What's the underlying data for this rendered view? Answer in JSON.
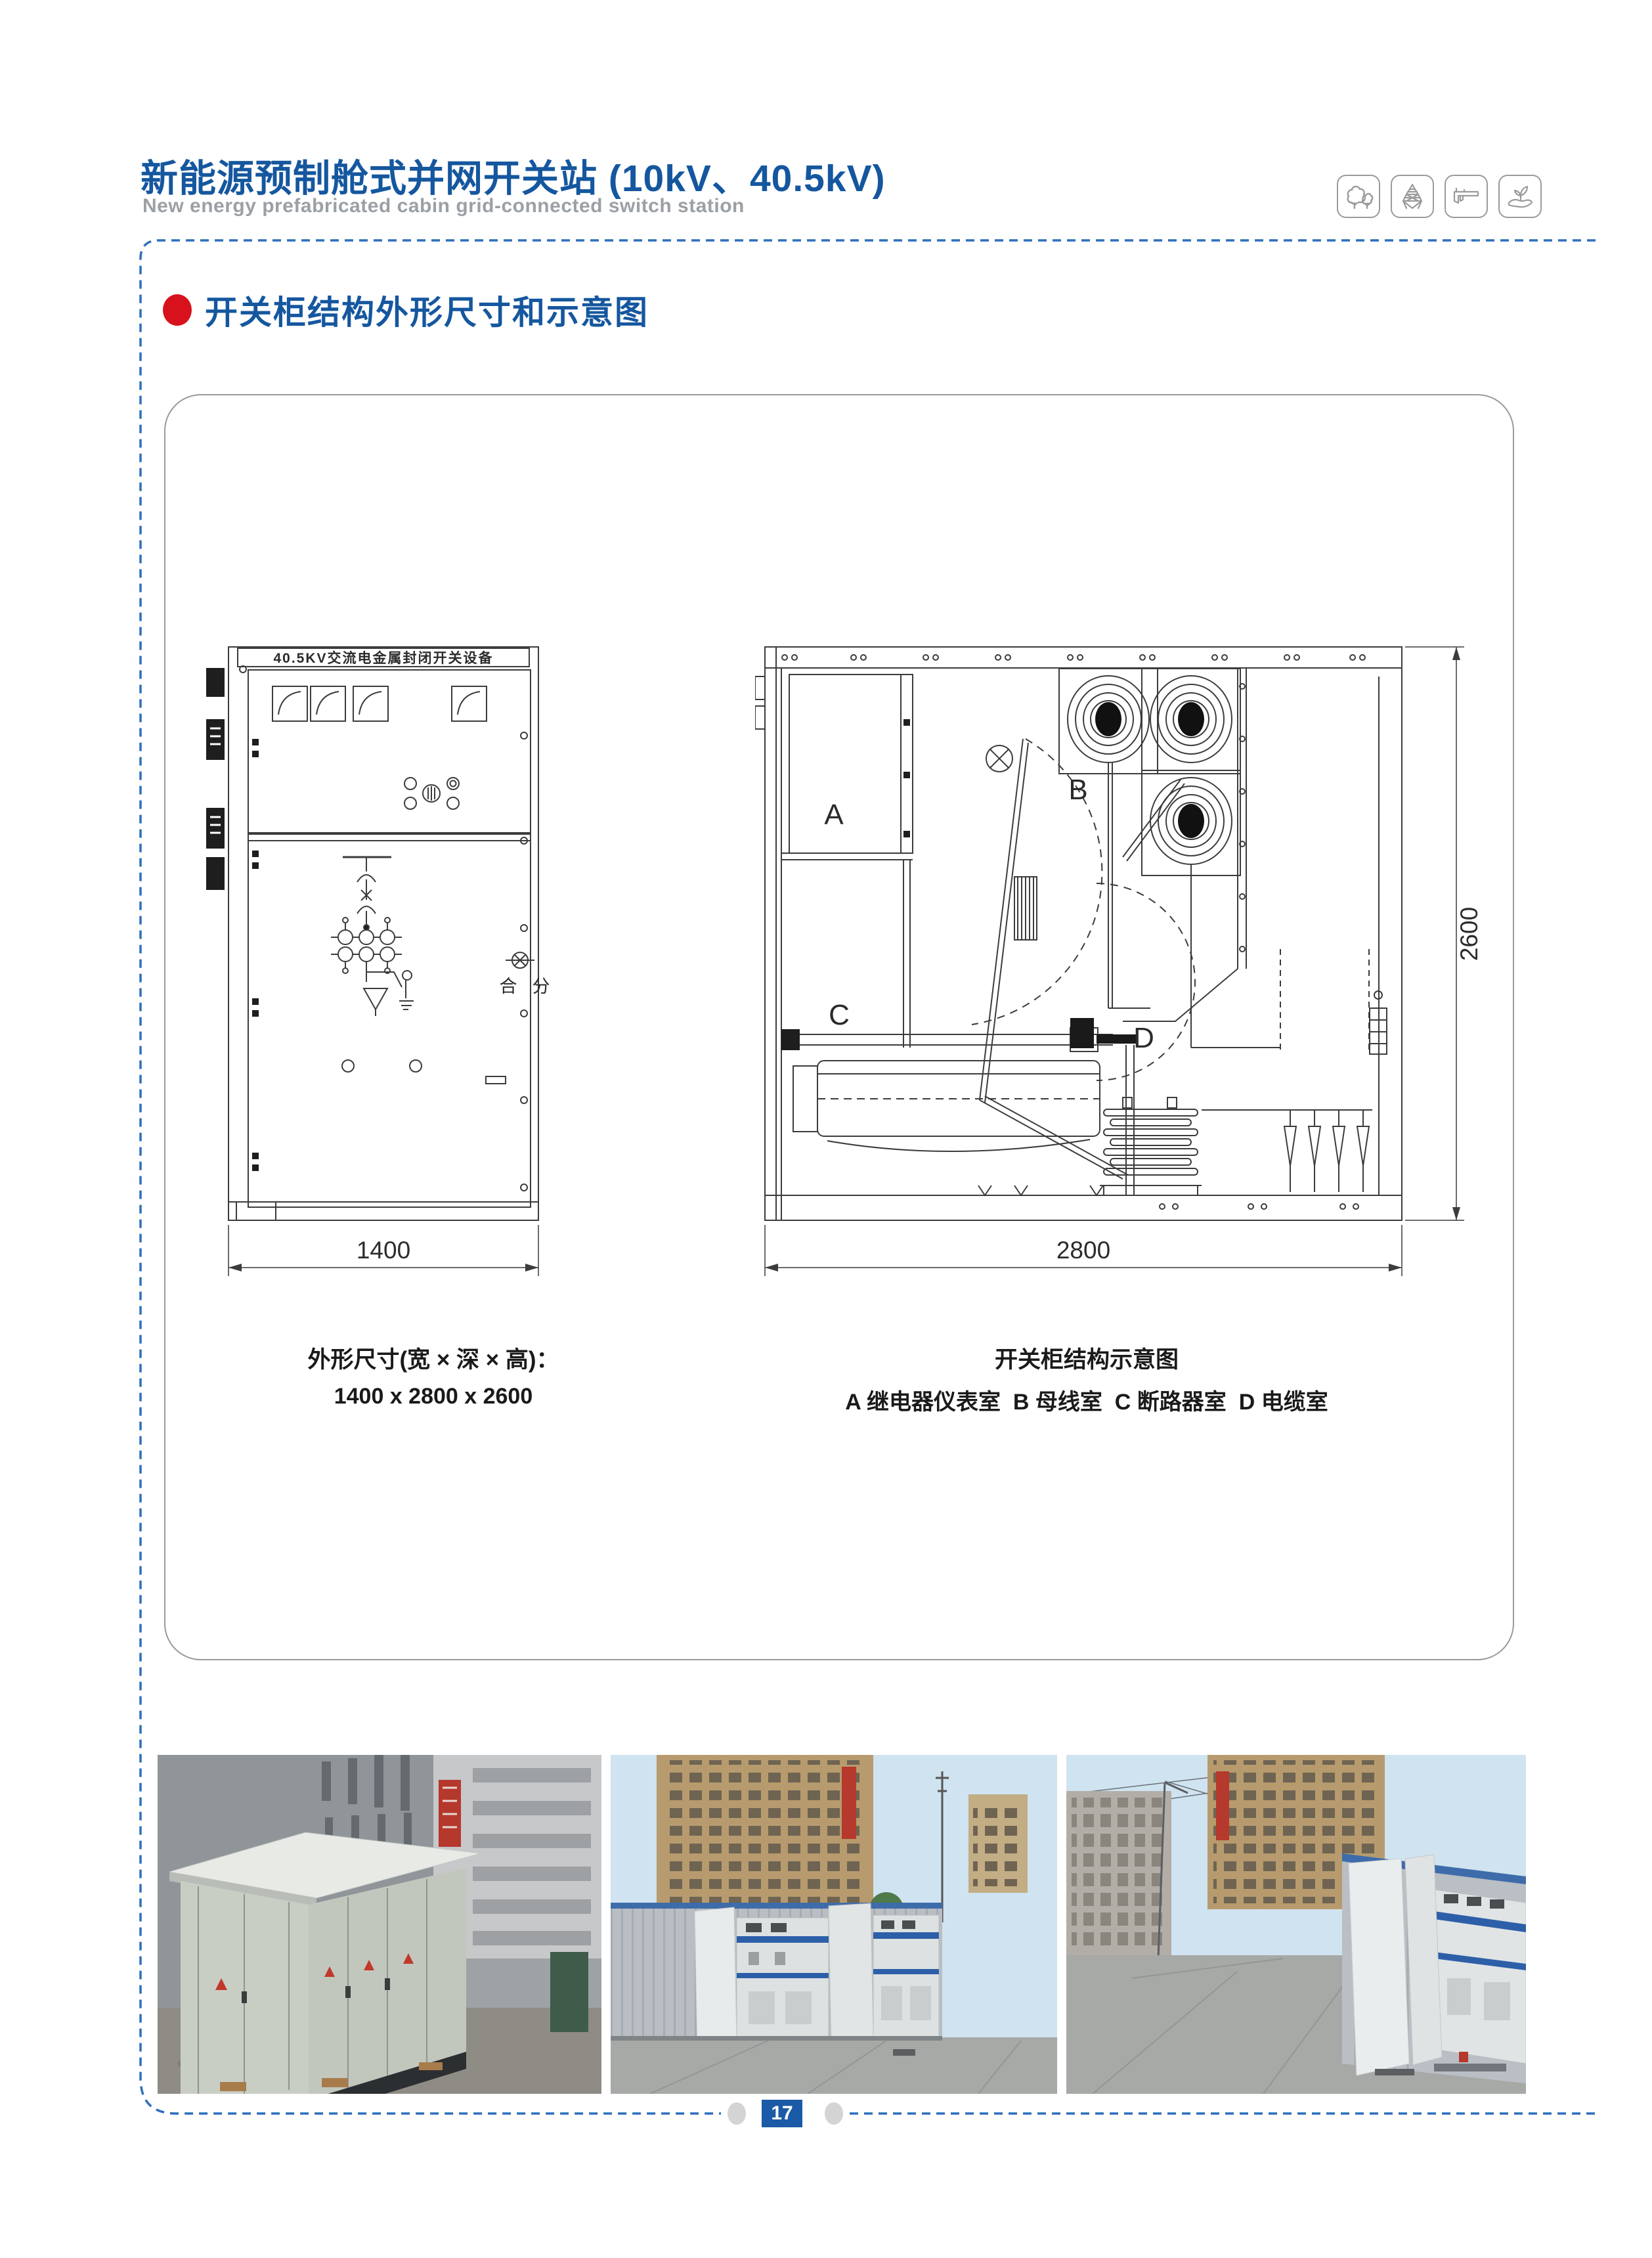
{
  "header": {
    "title": "新能源预制舱式并网开关站 (10kV、40.5kV)",
    "subtitle": "New energy prefabricated cabin grid-connected switch station"
  },
  "icons": [
    {
      "name": "trees-icon"
    },
    {
      "name": "power-tower-icon"
    },
    {
      "name": "caliper-icon"
    },
    {
      "name": "hand-plant-icon"
    }
  ],
  "section_heading": "开关柜结构外形尺寸和示意图",
  "front_view": {
    "nameplate": "40.5KV交流电金属封闭开关设备",
    "close_label": "合",
    "open_label": "分",
    "width_dim": "1400"
  },
  "section_view": {
    "label_a": "A",
    "label_b": "B",
    "label_c": "C",
    "label_d": "D",
    "width_dim": "2800",
    "height_dim": "2600"
  },
  "captions": {
    "left_title": "外形尺寸(宽 × 深 × 高)：",
    "left_value": "1400 x 2800 x 2600",
    "right_title": "开关柜结构示意图",
    "right_value": "A 继电器仪表室  B 母线室  C 断路器室  D 电缆室"
  },
  "footer": {
    "page_number": "17"
  },
  "colors": {
    "accent_blue": "#15579f",
    "bullet_red": "#d8121c",
    "dashed_blue": "#2e6fbd",
    "badge_blue": "#1b5aa6",
    "drawing_line": "#3c3c3c"
  }
}
